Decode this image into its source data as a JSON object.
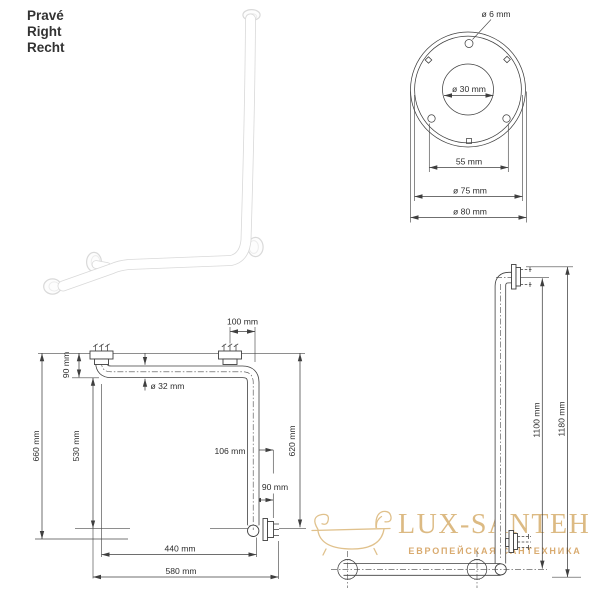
{
  "variant": {
    "cs": "Pravé",
    "en": "Right",
    "de": "Recht"
  },
  "flange_detail": {
    "screw_hole": "ø 6 mm",
    "bore": "ø 30 mm",
    "bolt_spacing": "55 mm",
    "ring_diameter": "ø 75 mm",
    "outer_diameter": "ø 80 mm"
  },
  "plan_view": {
    "top_offset": "100 mm",
    "wall_offset": "90 mm",
    "overall_height": "660 mm",
    "inner_height": "530 mm",
    "tube_diameter": "ø 32 mm",
    "side_offset": "106 mm",
    "right_height": "620 mm",
    "bottom_offset": "90 mm",
    "inner_width": "440 mm",
    "overall_width": "580 mm"
  },
  "side_view": {
    "center_height": "1100 mm",
    "overall_height": "1180 mm"
  },
  "watermark": {
    "brand": "LUX-SANTEH",
    "tagline": "ЕВРОПЕЙСКАЯ САНТЕХНИКА"
  }
}
